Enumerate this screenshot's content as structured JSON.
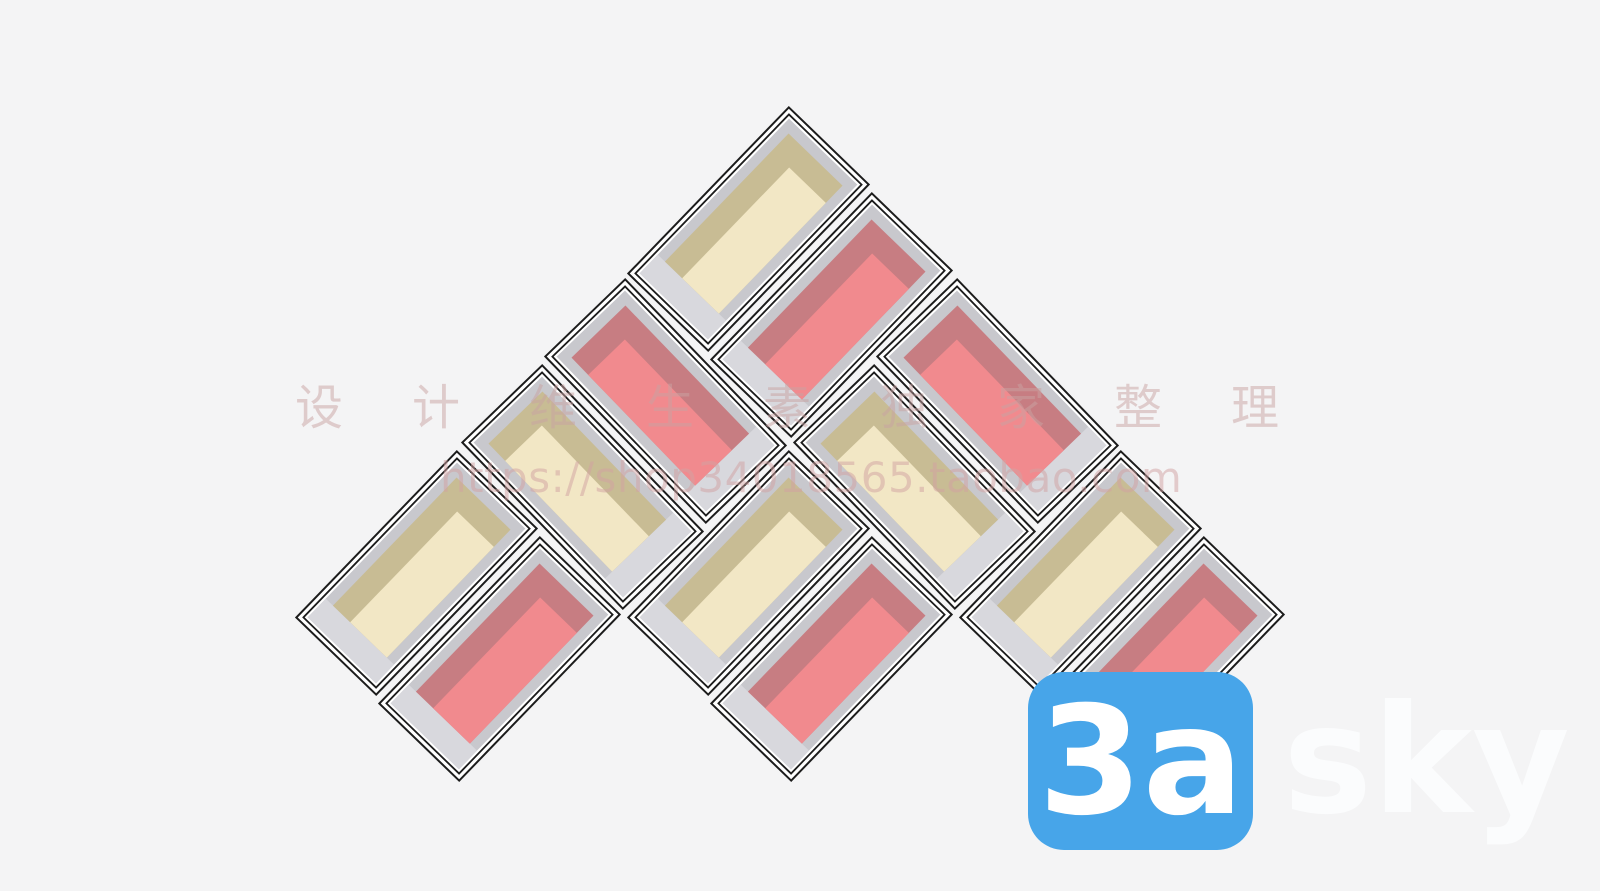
{
  "background_color": "#f4f4f5",
  "shelf": {
    "description": "wall shelf unit of 12 diagonal box compartments arranged as three chevron columns",
    "outline_color": "#1c1c1c",
    "gap_color": "#ffffff",
    "frame_color": "#c8c8cd",
    "frame_light_color": "#d8d8dd",
    "box_length": 231,
    "box_width": 111,
    "colors": {
      "cream": {
        "main": "#f2e7c5",
        "shadow": "#c8bc94"
      },
      "pink": {
        "main": "#f18a8e",
        "shadow": "#c77d82"
      }
    },
    "boxes": [
      {
        "cx": 748.5,
        "cy": 229,
        "rot": -46,
        "mirror": false,
        "color": "cream"
      },
      {
        "cx": 831.5,
        "cy": 315,
        "rot": -46,
        "mirror": false,
        "color": "pink"
      },
      {
        "cx": 665.5,
        "cy": 401,
        "rot": 46,
        "mirror": true,
        "color": "pink"
      },
      {
        "cx": 582.5,
        "cy": 487,
        "rot": 46,
        "mirror": true,
        "color": "cream"
      },
      {
        "cx": 997.5,
        "cy": 401,
        "rot": 46,
        "mirror": true,
        "color": "pink"
      },
      {
        "cx": 914.5,
        "cy": 487,
        "rot": 46,
        "mirror": true,
        "color": "cream"
      },
      {
        "cx": 416.5,
        "cy": 573,
        "rot": -46,
        "mirror": false,
        "color": "cream"
      },
      {
        "cx": 499.5,
        "cy": 659,
        "rot": -46,
        "mirror": false,
        "color": "pink"
      },
      {
        "cx": 748.5,
        "cy": 573,
        "rot": -46,
        "mirror": false,
        "color": "cream"
      },
      {
        "cx": 831.5,
        "cy": 659,
        "rot": -46,
        "mirror": false,
        "color": "pink"
      },
      {
        "cx": 1080.5,
        "cy": 573,
        "rot": -46,
        "mirror": false,
        "color": "cream"
      },
      {
        "cx": 1163.5,
        "cy": 659,
        "rot": -46,
        "mirror": false,
        "color": "pink"
      }
    ]
  },
  "watermark": {
    "cn_text": "设计维生素独家整理",
    "cn_color": "#c9a3a3",
    "url_text": "https://shop34018565.taobao.com",
    "url_color": "#d2a2a2"
  },
  "logo": {
    "badge_text": "3a",
    "suffix_text": "sky",
    "badge_color": "#47a5e9",
    "badge_text_color": "#ffffff",
    "suffix_color": "#fbfcfd"
  }
}
